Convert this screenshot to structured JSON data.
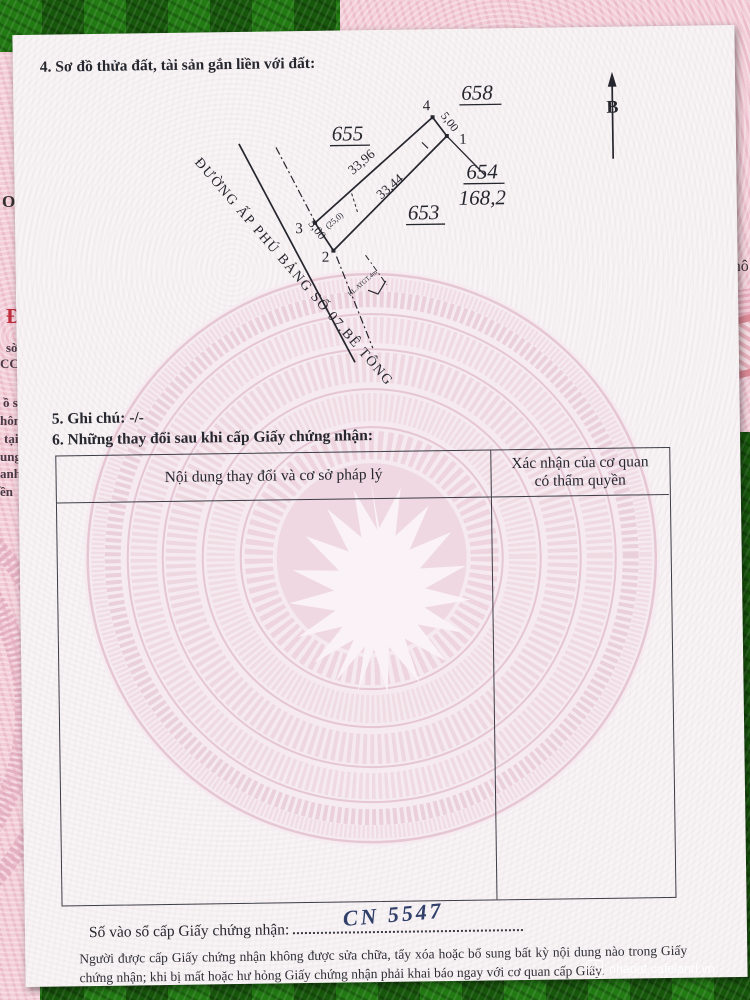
{
  "page": {
    "section4_title": "4. Sơ đồ thửa đất, tài sản gắn liền với đất:",
    "section5": "5. Ghi chú: -/-",
    "section6": "6. Những thay đổi sau khi cấp Giấy chứng nhận:",
    "table": {
      "col1_header": "Nội dung thay đổi và cơ sở pháp lý",
      "col2_header_line1": "Xác nhận của cơ quan",
      "col2_header_line2": "có thẩm quyền"
    },
    "entry_label": "Số vào sổ cấp Giấy chứng nhận:",
    "entry_number_handwritten": "CN 5547",
    "footer_note": "Người được cấp Giấy chứng nhận không được sửa chữa, tẩy xóa hoặc bổ sung bất kỳ nội dung nào trong Giấy chứng nhận; khi bị mất hoặc hư hỏng Giấy chứng nhận phải khai báo ngay với cơ quan cấp Giấy."
  },
  "diagram": {
    "north_label": "B",
    "road_label": "ĐƯỜNG ẤP PHÚ BẢNG SỐ 07.BÊ TÔNG",
    "parcel_number": "654",
    "parcel_area": "168,2",
    "adjacent_parcels": [
      "655",
      "658",
      "653"
    ],
    "vertex_labels": {
      "v1": "1",
      "v2": "2",
      "v3": "3",
      "v4": "4"
    },
    "edge_lengths": {
      "top_width": "5,00",
      "northwest_side": "33,96",
      "southeast_side": "33,44",
      "road_front_width": "5,00",
      "segment": "(25,0)"
    },
    "corridor_note": "HL.ATGT.4m"
  },
  "left_page": {
    "fragments": [
      "ON",
      "Đ",
      "sờ",
      "CCI",
      "ồ s",
      "hôn",
      "tại",
      "ung",
      "anh",
      "ền"
    ]
  },
  "right_page": {
    "fragment": "Thô"
  },
  "photo_watermark": {
    "site": "nhadat.cafeland.vn"
  },
  "colors": {
    "mat_green": "#1c660f",
    "page_white": "#f8f4f5",
    "drum_pink": "#eed4de",
    "under_page_pink": "#f3cdd8",
    "ink": "#26262e",
    "handwriting_ink": "#31406b"
  }
}
